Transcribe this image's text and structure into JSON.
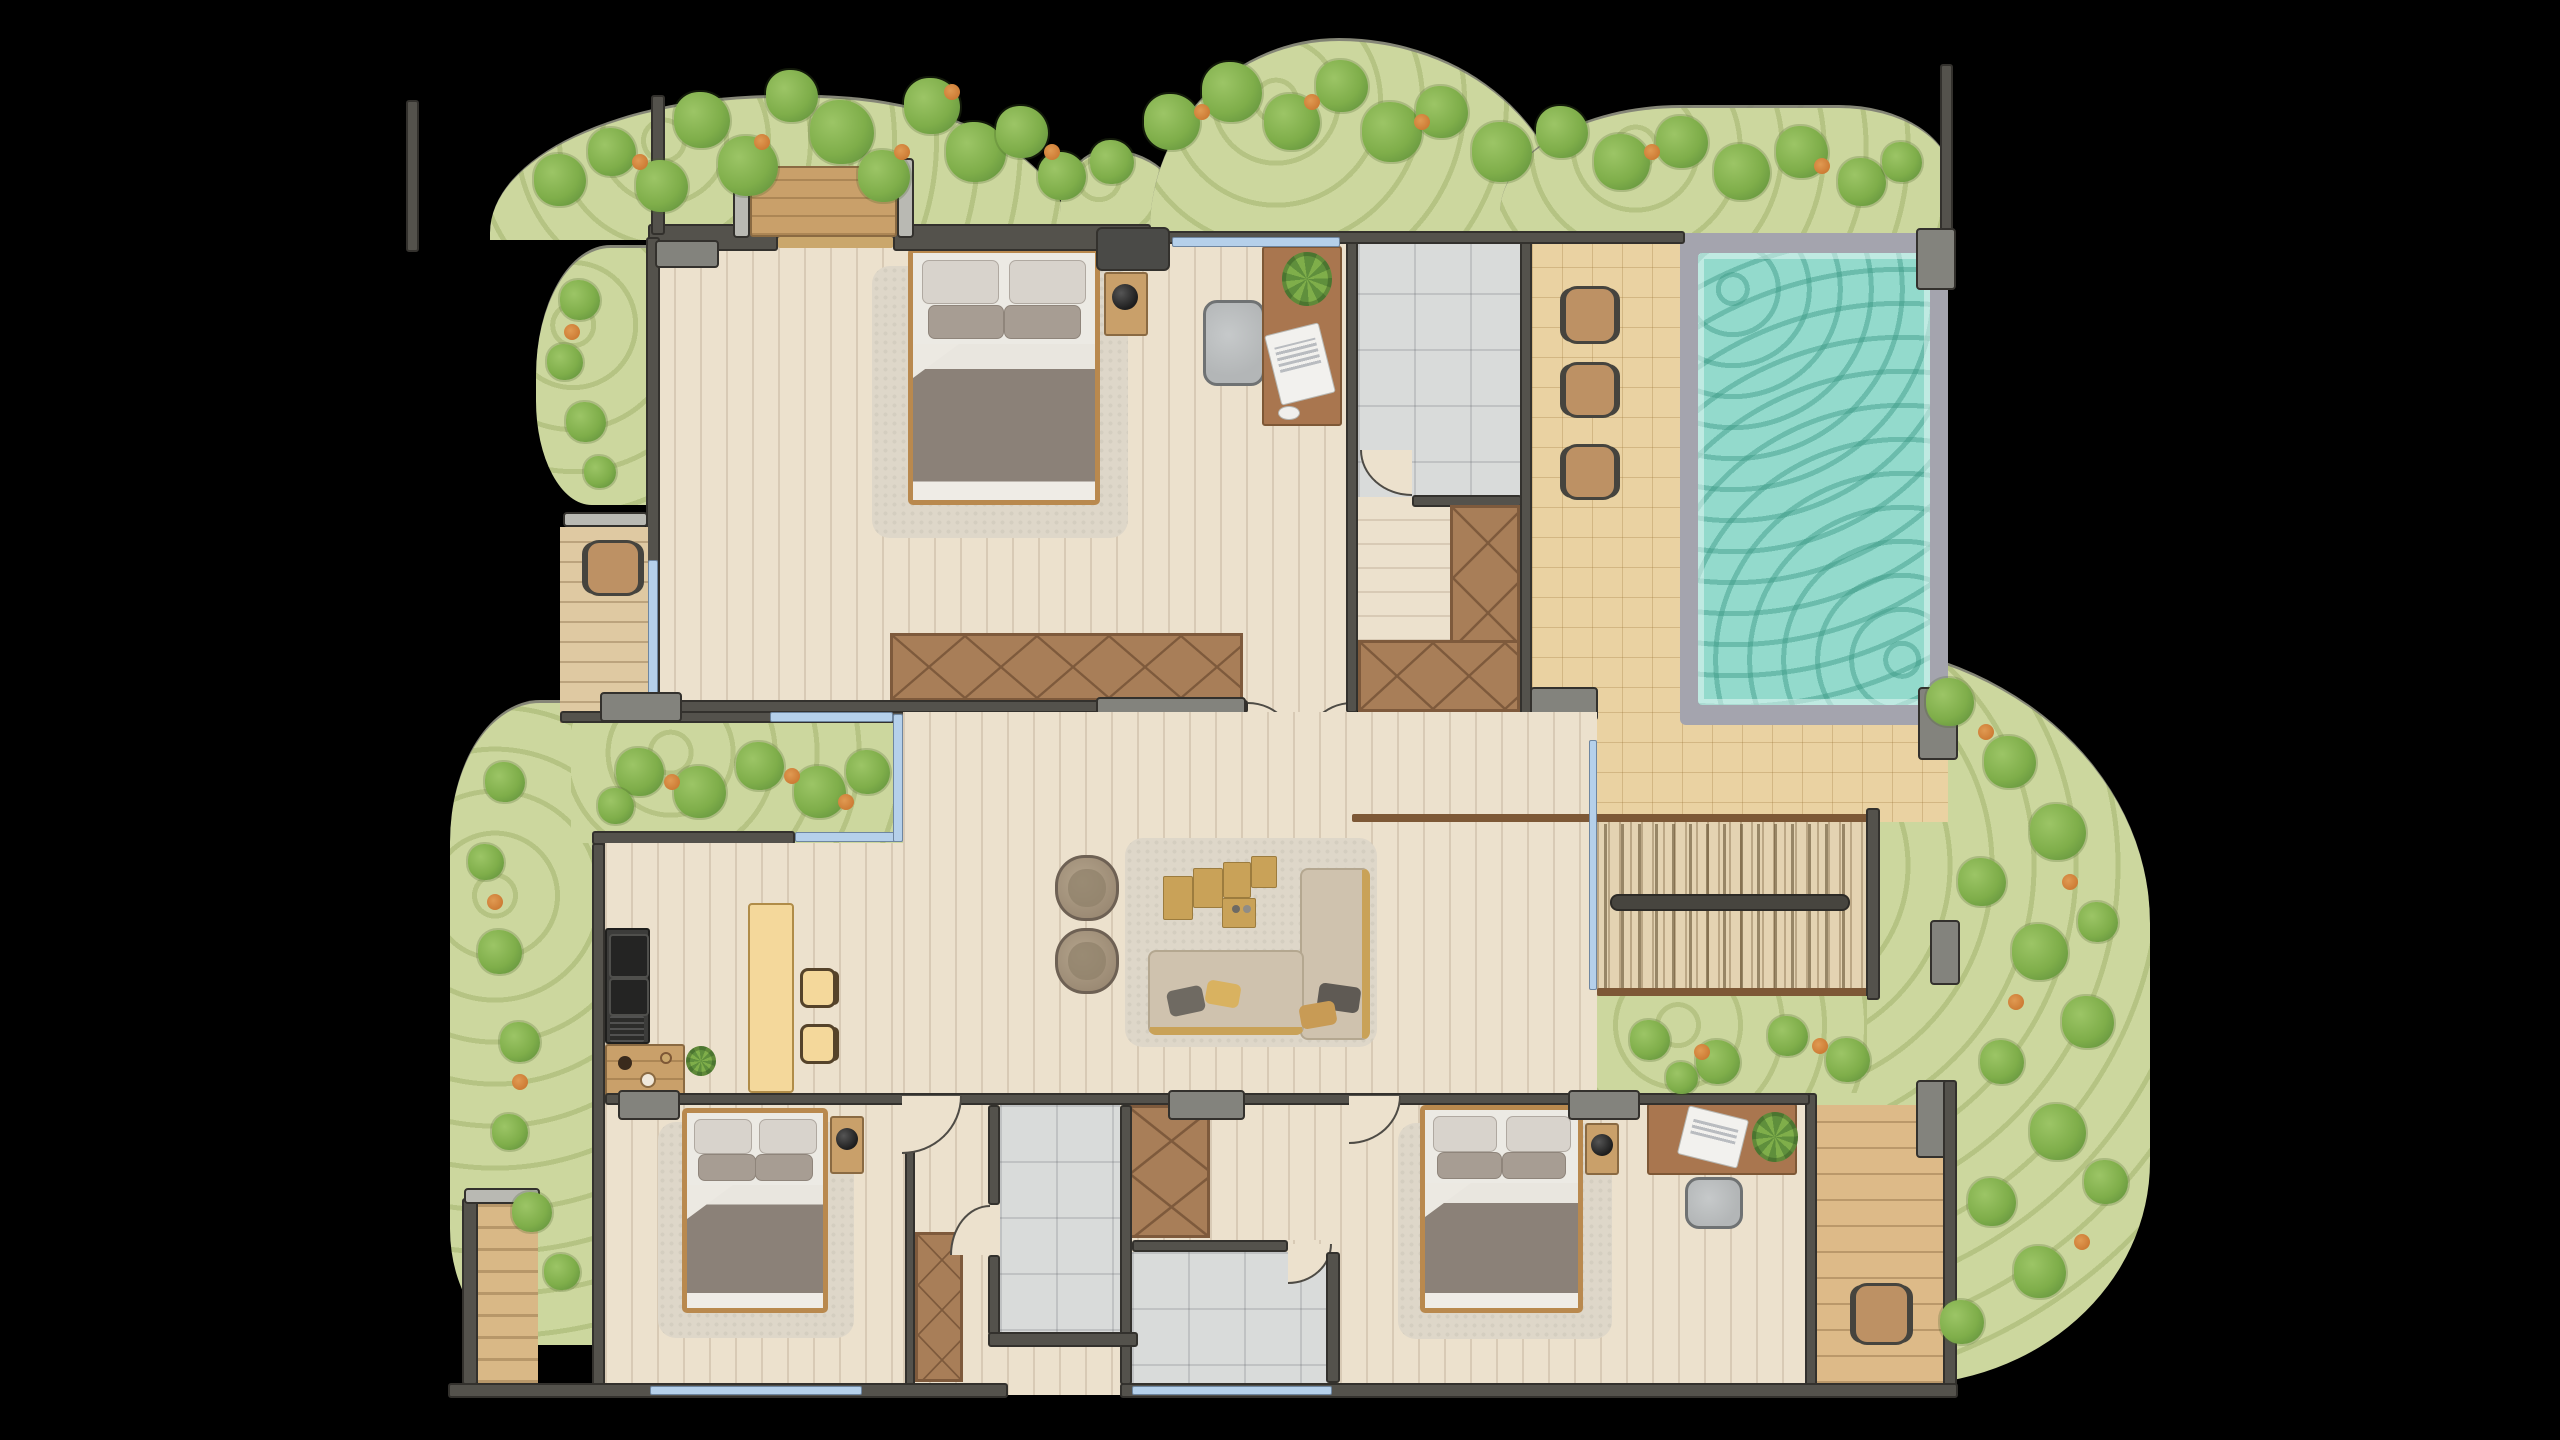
{
  "scene": {
    "type": "top-down architectural floor plan render of a villa",
    "background": "#000000",
    "no_visible_text": true
  },
  "palette": {
    "floor": "#ece1cd",
    "floorline": "rgba(110,85,55,0.16)",
    "balcony": "#dfc9a2",
    "tile": "#d9dbda",
    "tileline": "rgba(80,85,90,0.18)",
    "deck": "#ead2a2",
    "deckline": "rgba(150,110,50,0.28)",
    "water": "#93dacc",
    "wave": "rgba(58,152,132,0.45)",
    "rim": "#a4a4ae",
    "wall": "#54524c",
    "walldark": "#33312d",
    "lintel": "#83837d",
    "wood": "#c9a06a",
    "woodline": "rgba(95,65,30,0.28)",
    "wardrobe": "#a87e58",
    "wardrobeline": "#7e5a3c",
    "window": "#b5d0ea",
    "garden": "#ccd79e",
    "gardenstripe": "rgba(130,150,70,0.30)",
    "bush1": "#7fae4a",
    "bush2": "#5f8f3c",
    "bush3": "#9cc566",
    "flower": "#cd7c35",
    "rug": "#ded7c9",
    "bedframe": "#b9894e",
    "duvet": "#eceae4",
    "blanket": "#8b8178",
    "sofa": "#cfc2ae",
    "gold": "#c9a258",
    "chairbrown": "#bd9164",
    "graychair": "#b3b6b7",
    "darkline": "#4e4b45",
    "counter": "#3c3c3a",
    "island": "#f4d89b",
    "desk": "#a9764f"
  },
  "labels": {
    "floor_plan": "Villa floor plan",
    "master_bedroom": "Master bedroom",
    "office_nook": "Office nook",
    "upper_bathroom": "Bathroom",
    "walk_in_closet": "Walk-in closet",
    "pool": "Swimming pool",
    "pool_deck": "Pool deck",
    "staircase": "Staircase",
    "living_room": "Living room",
    "kitchen": "Kitchen",
    "bedroom_2": "Bedroom",
    "bedroom_3": "Bedroom",
    "bathroom_2": "Bathroom",
    "bathroom_3": "Bathroom",
    "hallway": "Hallway",
    "balcony_left": "Balcony",
    "balcony_right": "Balcony",
    "garden_north": "Garden",
    "garden_east": "Garden",
    "garden_west": "Garden",
    "courtyard_garden": "Courtyard garden",
    "planter": "Planter bench"
  },
  "inventory": {
    "beds": 3,
    "bathrooms": 3,
    "deck_chairs": 3,
    "armchairs": 2,
    "island_chairs": 2,
    "desks": 2,
    "office_chairs": 2,
    "wardrobes": 4,
    "staircase_flights": 2,
    "plants": 4,
    "sofas": 1,
    "kitchen_counter": 1,
    "kitchen_island": 1
  }
}
